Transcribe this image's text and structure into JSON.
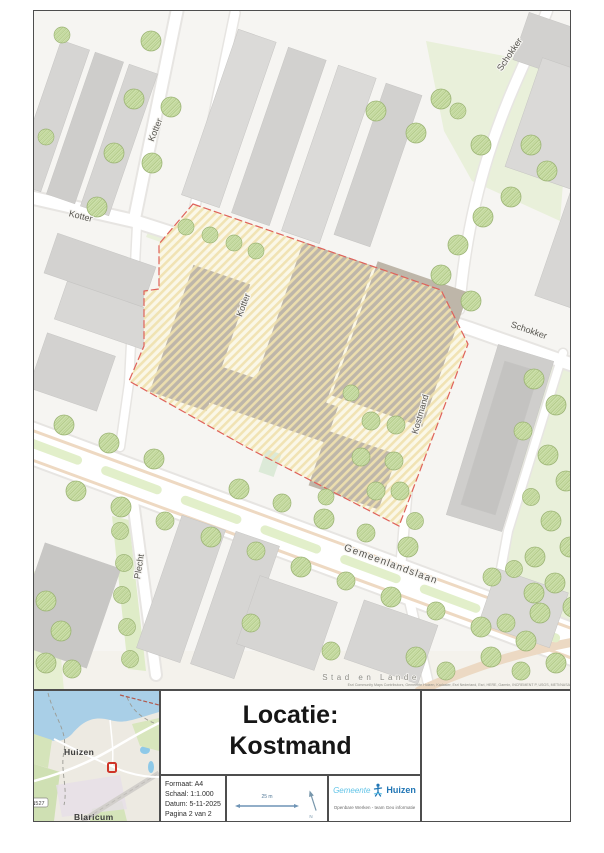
{
  "sheet": {
    "map": {
      "street_labels": {
        "kotter_top": "Kotter",
        "kotter_left": "Kotter",
        "kotter_mid": "Kotter",
        "schokker_top": "Schokker",
        "schokker": "Schokker",
        "kostmand": "Kostmand",
        "gemeenlandslaan": "Gemeenlandslaan",
        "plecht": "Plecht"
      },
      "area_label": "Stad en Lande",
      "attribution": "Esri Community Maps Contributors, Gemeente Huizen, Kadaster, Esri Nederland, Esri, HERE, Garmin, INCREMENT P, USGS, METI/NASA"
    },
    "inset": {
      "huizen": "Huizen",
      "blaricum": "Blaricum",
      "road_shield": "N527"
    },
    "title_block": {
      "line1": "Locatie:",
      "line2": "Kostmand"
    },
    "metadata": {
      "formaat": "Formaat: A4",
      "schaal": "Schaal: 1:1.000",
      "datum": "Datum: 5-11-2025",
      "pagina": "Pagina 2 van 2"
    },
    "scalebar": {
      "label": "25 m",
      "north": "N"
    },
    "logo": {
      "prefix": "Gemeente",
      "name": "Huizen",
      "subtitle": "Openbare Werken - team Geo informatie"
    },
    "colors": {
      "parcel_border": "#df625b",
      "parcel_fill": "#fbf7e6",
      "tree_green": "#cde0ab",
      "logo_blue": "#2176b5",
      "logo_light": "#5fc3e7",
      "scalebar_blue": "#7796ab",
      "marker_red": "#cf3428"
    }
  }
}
